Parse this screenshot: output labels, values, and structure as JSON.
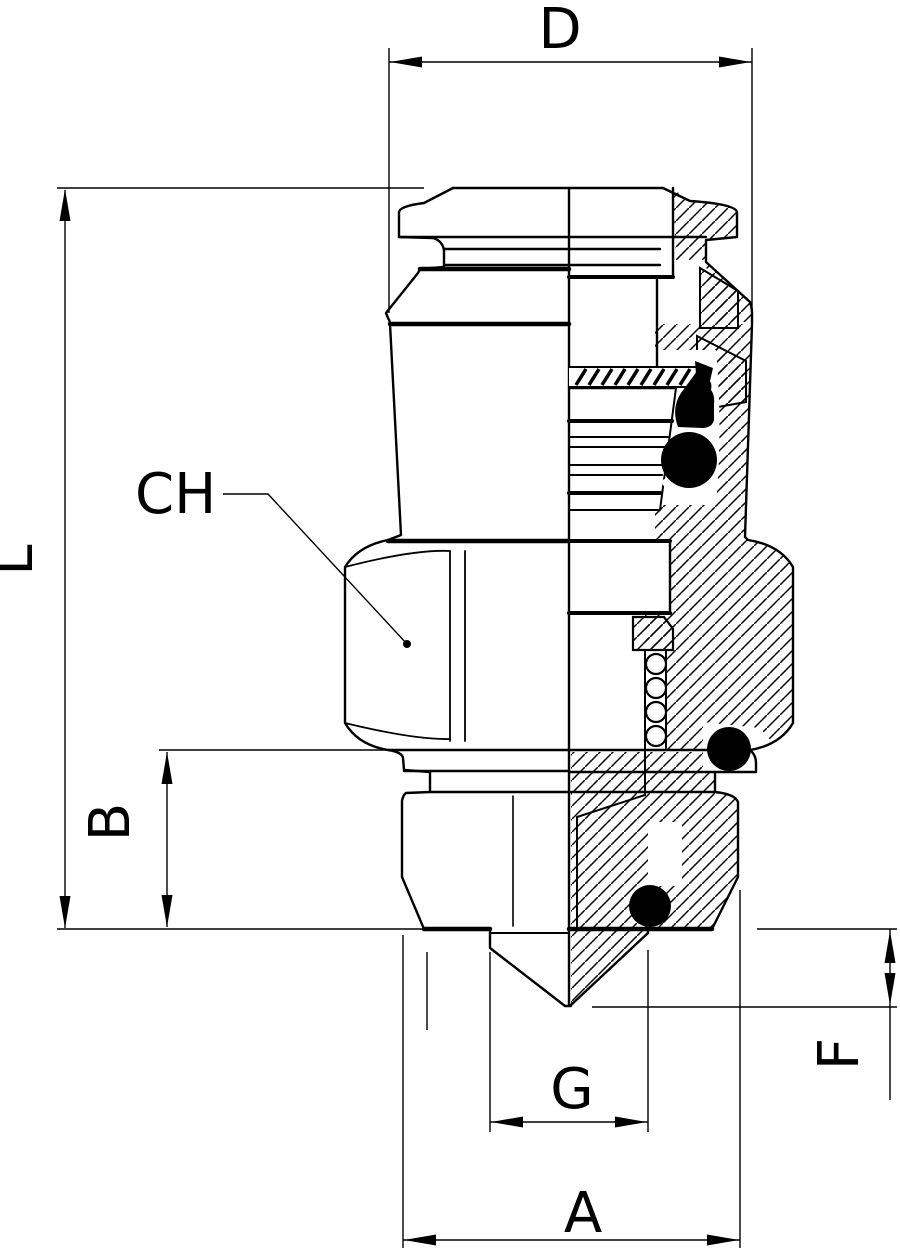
{
  "drawing": {
    "kind": "pneumatic-push-in-fitting-half-section",
    "labels": {
      "d": "D",
      "l": "L",
      "b": "B",
      "ch": "CH",
      "g": "G",
      "a": "A",
      "f": "F"
    },
    "colors": {
      "line": "#000000",
      "background": "#ffffff",
      "seal_fill": "#000000"
    }
  }
}
